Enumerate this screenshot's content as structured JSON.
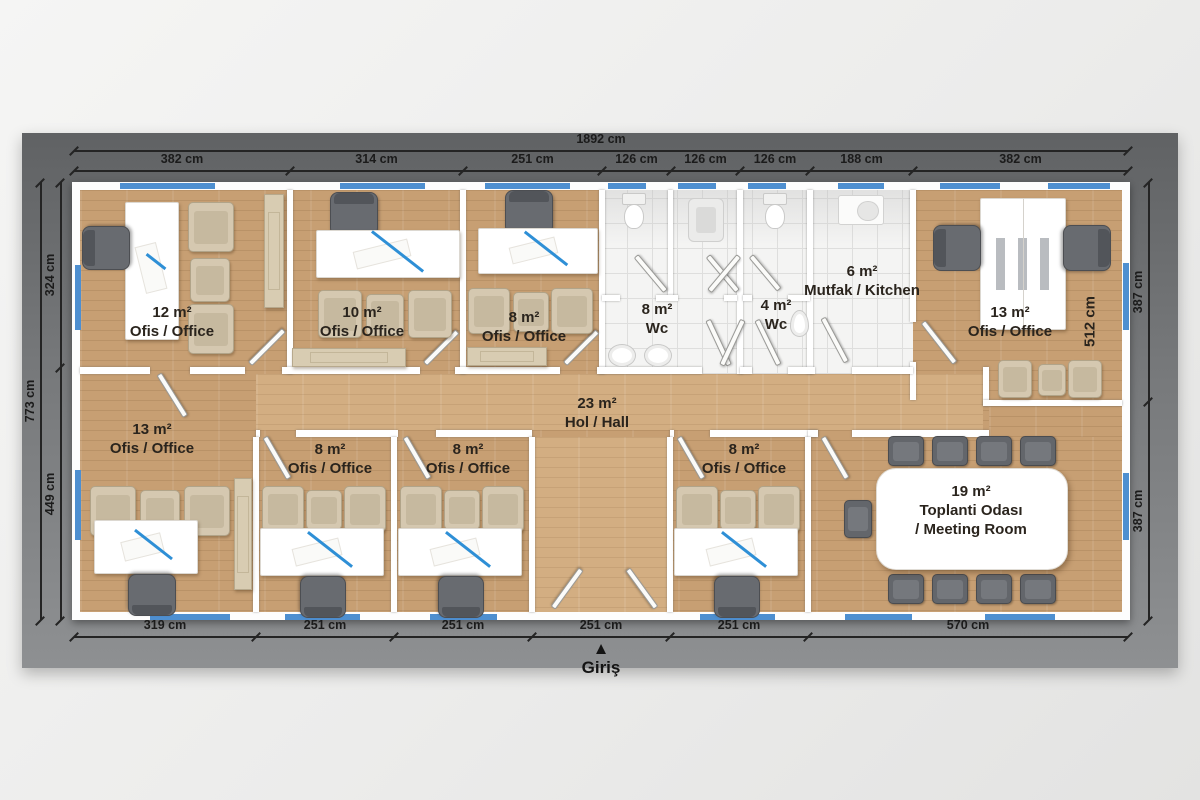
{
  "plan": {
    "entrance": {
      "arrow": "▲",
      "label": "Giriş"
    },
    "colors": {
      "mat": "#77797b",
      "wall": "#ffffff",
      "wood_floor": "#c79f73",
      "hall_floor": "#d3ae82",
      "tile_floor": "#f4f4f3",
      "window_blue": "#4e8fd0",
      "dimension_text": "#1b1b1b",
      "label_text": "#2a241d"
    },
    "labels": [
      {
        "x": 172,
        "y": 303,
        "lines": [
          "12 m²",
          "Ofis / Office"
        ]
      },
      {
        "x": 362,
        "y": 303,
        "lines": [
          "10 m²",
          "Ofis / Office"
        ]
      },
      {
        "x": 524,
        "y": 308,
        "lines": [
          "8 m²",
          "Ofis / Office"
        ]
      },
      {
        "x": 657,
        "y": 300,
        "lines": [
          "8 m²",
          "Wc"
        ]
      },
      {
        "x": 776,
        "y": 296,
        "lines": [
          "4 m²",
          "Wc"
        ]
      },
      {
        "x": 862,
        "y": 262,
        "lines": [
          "6 m²",
          "Mutfak / Kitchen"
        ]
      },
      {
        "x": 1010,
        "y": 303,
        "lines": [
          "13 m²",
          "Ofis / Office"
        ]
      },
      {
        "x": 597,
        "y": 394,
        "lines": [
          "23 m²",
          "Hol / Hall"
        ]
      },
      {
        "x": 152,
        "y": 420,
        "lines": [
          "13 m²",
          "Ofis / Office"
        ]
      },
      {
        "x": 330,
        "y": 440,
        "lines": [
          "8 m²",
          "Ofis / Office"
        ]
      },
      {
        "x": 468,
        "y": 440,
        "lines": [
          "8 m²",
          "Ofis / Office"
        ]
      },
      {
        "x": 744,
        "y": 440,
        "lines": [
          "8 m²",
          "Ofis / Office"
        ]
      },
      {
        "x": 971,
        "y": 482,
        "lines": [
          "19 m²",
          "Toplanti Odası",
          "/ Meeting Room"
        ]
      },
      {
        "x": 1090,
        "y": 312,
        "lines": [
          "512 cm"
        ],
        "vertical": true
      }
    ],
    "dims": [
      {
        "orient": "h",
        "pos": 150,
        "ticks": [
          74,
          1128
        ],
        "labels": [
          "1892 cm"
        ],
        "name": "dim-top-total"
      },
      {
        "orient": "h",
        "pos": 170,
        "ticks": [
          74,
          290,
          463,
          602,
          671,
          740,
          810,
          913,
          1128
        ],
        "labels": [
          "382 cm",
          "314 cm",
          "251 cm",
          "126 cm",
          "126 cm",
          "126 cm",
          "188 cm",
          "382 cm"
        ],
        "name": "dim-top-segments"
      },
      {
        "orient": "v",
        "pos": 40,
        "ticks": [
          182,
          620
        ],
        "labels": [
          "773 cm"
        ],
        "name": "dim-left-total"
      },
      {
        "orient": "v",
        "pos": 60,
        "ticks": [
          182,
          367,
          620
        ],
        "labels": [
          "324 cm",
          "449 cm"
        ],
        "name": "dim-left-segments"
      },
      {
        "orient": "v",
        "pos": 1148,
        "ticks": [
          182,
          401,
          620
        ],
        "labels": [
          "387 cm",
          "387 cm"
        ],
        "name": "dim-right-segments"
      },
      {
        "orient": "h",
        "pos": 636,
        "ticks": [
          74,
          256,
          394,
          532,
          670,
          808,
          1128
        ],
        "labels": [
          "319 cm",
          "251 cm",
          "251 cm",
          "251 cm",
          "251 cm",
          "570 cm"
        ],
        "name": "dim-bottom-segments"
      }
    ]
  },
  "geometry": {
    "floors": [
      {
        "x": 80,
        "y": 190,
        "w": 1042,
        "h": 422,
        "cls": "wood",
        "name": "floor-wood-base"
      },
      {
        "x": 602,
        "y": 190,
        "w": 311,
        "h": 184,
        "cls": "tile",
        "name": "floor-tiles-wet-area"
      },
      {
        "x": 256,
        "y": 374,
        "w": 727,
        "h": 56,
        "cls": "wood-light",
        "name": "floor-hall"
      },
      {
        "x": 532,
        "y": 437,
        "w": 138,
        "h": 175,
        "cls": "wood-light",
        "name": "floor-entry-corridor"
      },
      {
        "x": 989,
        "y": 406,
        "w": 133,
        "h": 31,
        "cls": "wood",
        "name": "floor-meeting-strip"
      }
    ],
    "walls": [
      {
        "x": 287,
        "y": 190,
        "w": 6,
        "h": 184
      },
      {
        "x": 460,
        "y": 190,
        "w": 6,
        "h": 184
      },
      {
        "x": 599,
        "y": 190,
        "w": 6,
        "h": 184
      },
      {
        "x": 668,
        "y": 190,
        "w": 5,
        "h": 108
      },
      {
        "x": 737,
        "y": 190,
        "w": 6,
        "h": 184
      },
      {
        "x": 807,
        "y": 190,
        "w": 6,
        "h": 184
      },
      {
        "x": 910,
        "y": 190,
        "w": 6,
        "h": 132
      },
      {
        "x": 910,
        "y": 362,
        "w": 6,
        "h": 38
      },
      {
        "x": 602,
        "y": 295,
        "w": 18,
        "h": 6
      },
      {
        "x": 656,
        "y": 295,
        "w": 22,
        "h": 6
      },
      {
        "x": 724,
        "y": 295,
        "w": 13,
        "h": 6
      },
      {
        "x": 743,
        "y": 295,
        "w": 9,
        "h": 6
      },
      {
        "x": 788,
        "y": 295,
        "w": 22,
        "h": 6
      },
      {
        "x": 80,
        "y": 367,
        "w": 70,
        "h": 7
      },
      {
        "x": 190,
        "y": 367,
        "w": 55,
        "h": 7
      },
      {
        "x": 282,
        "y": 367,
        "w": 138,
        "h": 7
      },
      {
        "x": 455,
        "y": 367,
        "w": 105,
        "h": 7
      },
      {
        "x": 597,
        "y": 367,
        "w": 105,
        "h": 7
      },
      {
        "x": 740,
        "y": 367,
        "w": 12,
        "h": 7
      },
      {
        "x": 788,
        "y": 367,
        "w": 27,
        "h": 7
      },
      {
        "x": 852,
        "y": 367,
        "w": 61,
        "h": 7
      },
      {
        "x": 256,
        "y": 430,
        "w": 4,
        "h": 7
      },
      {
        "x": 296,
        "y": 430,
        "w": 102,
        "h": 7
      },
      {
        "x": 436,
        "y": 430,
        "w": 96,
        "h": 7
      },
      {
        "x": 670,
        "y": 430,
        "w": 4,
        "h": 7
      },
      {
        "x": 710,
        "y": 430,
        "w": 108,
        "h": 7
      },
      {
        "x": 852,
        "y": 430,
        "w": 137,
        "h": 7
      },
      {
        "x": 808,
        "y": 430,
        "w": 10,
        "h": 7
      },
      {
        "x": 253,
        "y": 437,
        "w": 6,
        "h": 175
      },
      {
        "x": 391,
        "y": 437,
        "w": 6,
        "h": 175
      },
      {
        "x": 529,
        "y": 437,
        "w": 6,
        "h": 175
      },
      {
        "x": 667,
        "y": 437,
        "w": 6,
        "h": 175
      },
      {
        "x": 805,
        "y": 437,
        "w": 6,
        "h": 175
      },
      {
        "x": 983,
        "y": 367,
        "w": 6,
        "h": 39
      },
      {
        "x": 983,
        "y": 400,
        "w": 139,
        "h": 6
      }
    ],
    "windows": [
      {
        "x": 120,
        "y": 183,
        "w": 95,
        "h": 6
      },
      {
        "x": 340,
        "y": 183,
        "w": 85,
        "h": 6
      },
      {
        "x": 485,
        "y": 183,
        "w": 85,
        "h": 6
      },
      {
        "x": 608,
        "y": 183,
        "w": 38,
        "h": 6
      },
      {
        "x": 678,
        "y": 183,
        "w": 38,
        "h": 6
      },
      {
        "x": 748,
        "y": 183,
        "w": 38,
        "h": 6
      },
      {
        "x": 838,
        "y": 183,
        "w": 46,
        "h": 6
      },
      {
        "x": 940,
        "y": 183,
        "w": 60,
        "h": 6
      },
      {
        "x": 1048,
        "y": 183,
        "w": 62,
        "h": 6
      },
      {
        "x": 150,
        "y": 614,
        "w": 80,
        "h": 6
      },
      {
        "x": 285,
        "y": 614,
        "w": 75,
        "h": 6
      },
      {
        "x": 430,
        "y": 614,
        "w": 67,
        "h": 6
      },
      {
        "x": 700,
        "y": 614,
        "w": 75,
        "h": 6
      },
      {
        "x": 845,
        "y": 614,
        "w": 67,
        "h": 6
      },
      {
        "x": 985,
        "y": 614,
        "w": 70,
        "h": 6
      },
      {
        "x": 75,
        "y": 265,
        "w": 6,
        "h": 65
      },
      {
        "x": 75,
        "y": 470,
        "w": 6,
        "h": 70
      },
      {
        "x": 1123,
        "y": 263,
        "w": 6,
        "h": 67
      },
      {
        "x": 1123,
        "y": 473,
        "w": 6,
        "h": 67
      }
    ],
    "doors": [
      {
        "x": 247,
        "y": 364,
        "len": 46,
        "deg": -135,
        "name": "door-office-12"
      },
      {
        "x": 422,
        "y": 364,
        "len": 44,
        "deg": -135,
        "name": "door-office-10"
      },
      {
        "x": 562,
        "y": 364,
        "len": 44,
        "deg": -135,
        "name": "door-office-8-top"
      },
      {
        "x": 633,
        "y": 256,
        "len": 44,
        "deg": -40,
        "name": "door-wc-stall-1"
      },
      {
        "x": 705,
        "y": 256,
        "len": 44,
        "deg": -40,
        "name": "door-wc-stall-2a"
      },
      {
        "x": 736,
        "y": 256,
        "len": 44,
        "deg": 40,
        "name": "door-wc-stall-2b"
      },
      {
        "x": 748,
        "y": 256,
        "len": 42,
        "deg": -40,
        "name": "door-wc-stall-3"
      },
      {
        "x": 705,
        "y": 320,
        "len": 48,
        "deg": -25,
        "name": "door-wc-8-entry-a"
      },
      {
        "x": 740,
        "y": 320,
        "len": 48,
        "deg": 25,
        "name": "door-wc-8-entry-b"
      },
      {
        "x": 754,
        "y": 320,
        "len": 48,
        "deg": -26,
        "name": "door-wc-4-entry"
      },
      {
        "x": 820,
        "y": 318,
        "len": 48,
        "deg": -28,
        "name": "door-kitchen"
      },
      {
        "x": 920,
        "y": 322,
        "len": 50,
        "deg": -38,
        "name": "door-office-13-top"
      },
      {
        "x": 820,
        "y": 437,
        "len": 46,
        "deg": -30,
        "name": "door-meeting-room"
      },
      {
        "x": 156,
        "y": 374,
        "len": 48,
        "deg": -32,
        "name": "door-office-13-bottom"
      },
      {
        "x": 262,
        "y": 437,
        "len": 46,
        "deg": -30,
        "name": "door-office-8-b1"
      },
      {
        "x": 402,
        "y": 437,
        "len": 46,
        "deg": -30,
        "name": "door-office-8-b2"
      },
      {
        "x": 676,
        "y": 437,
        "len": 46,
        "deg": -30,
        "name": "door-office-8-b3"
      },
      {
        "x": 550,
        "y": 608,
        "len": 46,
        "deg": -144,
        "name": "door-entrance-left"
      },
      {
        "x": 653,
        "y": 608,
        "len": 46,
        "deg": 144,
        "name": "door-entrance-right"
      }
    ],
    "furniture": [
      {
        "type": "cabinet",
        "x": 264,
        "y": 194,
        "w": 18,
        "h": 112
      },
      {
        "type": "desk",
        "x": 125,
        "y": 202,
        "w": 52,
        "h": 136
      },
      {
        "type": "ochair",
        "x": 84,
        "y": 224,
        "w": 42,
        "h": 46,
        "deg": -90
      },
      {
        "type": "gchair",
        "x": 188,
        "y": 202,
        "w": 44,
        "h": 48
      },
      {
        "type": "gchair",
        "x": 190,
        "y": 258,
        "w": 38,
        "h": 42
      },
      {
        "type": "gchair",
        "x": 188,
        "y": 304,
        "w": 44,
        "h": 48
      },
      {
        "type": "ochair",
        "x": 330,
        "y": 192,
        "w": 46,
        "h": 42
      },
      {
        "type": "desk",
        "x": 316,
        "y": 230,
        "w": 142,
        "h": 46
      },
      {
        "type": "gchair",
        "x": 318,
        "y": 290,
        "w": 42,
        "h": 46
      },
      {
        "type": "gchair",
        "x": 366,
        "y": 294,
        "w": 36,
        "h": 40
      },
      {
        "type": "gchair",
        "x": 408,
        "y": 290,
        "w": 42,
        "h": 46
      },
      {
        "type": "credenza",
        "x": 292,
        "y": 348,
        "w": 112,
        "h": 17
      },
      {
        "type": "ochair",
        "x": 505,
        "y": 190,
        "w": 46,
        "h": 42
      },
      {
        "type": "desk",
        "x": 478,
        "y": 228,
        "w": 118,
        "h": 44
      },
      {
        "type": "gchair",
        "x": 468,
        "y": 288,
        "w": 40,
        "h": 44
      },
      {
        "type": "gchair",
        "x": 513,
        "y": 292,
        "w": 34,
        "h": 38
      },
      {
        "type": "gchair",
        "x": 551,
        "y": 288,
        "w": 40,
        "h": 44
      },
      {
        "type": "credenza",
        "x": 467,
        "y": 347,
        "w": 78,
        "h": 17
      },
      {
        "type": "toilet",
        "x": 622,
        "y": 193,
        "w": 24,
        "h": 36
      },
      {
        "type": "squat",
        "x": 688,
        "y": 198,
        "w": 34,
        "h": 42
      },
      {
        "type": "sink-round",
        "x": 608,
        "y": 344,
        "w": 26,
        "h": 21
      },
      {
        "type": "sink-round",
        "x": 644,
        "y": 344,
        "w": 26,
        "h": 21
      },
      {
        "type": "toilet",
        "x": 763,
        "y": 193,
        "w": 24,
        "h": 36
      },
      {
        "type": "sink-wall",
        "x": 790,
        "y": 310,
        "w": 17,
        "h": 25
      },
      {
        "type": "sink-kitchen",
        "x": 838,
        "y": 195,
        "w": 44,
        "h": 28
      },
      {
        "type": "desk-double",
        "x": 980,
        "y": 198,
        "w": 84,
        "h": 130
      },
      {
        "type": "ochair",
        "x": 934,
        "y": 224,
        "w": 44,
        "h": 46,
        "deg": -90
      },
      {
        "type": "ochair",
        "x": 1064,
        "y": 224,
        "w": 44,
        "h": 46,
        "deg": 90
      },
      {
        "type": "gchair",
        "x": 998,
        "y": 360,
        "w": 32,
        "h": 36
      },
      {
        "type": "gchair",
        "x": 1038,
        "y": 364,
        "w": 26,
        "h": 30
      },
      {
        "type": "gchair",
        "x": 1068,
        "y": 360,
        "w": 32,
        "h": 36
      },
      {
        "type": "gchair",
        "x": 90,
        "y": 486,
        "w": 44,
        "h": 48
      },
      {
        "type": "gchair",
        "x": 140,
        "y": 490,
        "w": 38,
        "h": 42
      },
      {
        "type": "gchair",
        "x": 184,
        "y": 486,
        "w": 44,
        "h": 48
      },
      {
        "type": "desk",
        "x": 94,
        "y": 520,
        "w": 102,
        "h": 52
      },
      {
        "type": "ochair",
        "x": 128,
        "y": 574,
        "w": 46,
        "h": 40,
        "deg": 180
      },
      {
        "type": "cabinet",
        "x": 234,
        "y": 478,
        "w": 16,
        "h": 110
      },
      {
        "type": "gchair",
        "x": 262,
        "y": 486,
        "w": 40,
        "h": 44
      },
      {
        "type": "gchair",
        "x": 306,
        "y": 490,
        "w": 34,
        "h": 38
      },
      {
        "type": "gchair",
        "x": 344,
        "y": 486,
        "w": 40,
        "h": 44
      },
      {
        "type": "desk",
        "x": 260,
        "y": 528,
        "w": 122,
        "h": 46
      },
      {
        "type": "ochair",
        "x": 300,
        "y": 576,
        "w": 44,
        "h": 40,
        "deg": 180
      },
      {
        "type": "gchair",
        "x": 400,
        "y": 486,
        "w": 40,
        "h": 44
      },
      {
        "type": "gchair",
        "x": 444,
        "y": 490,
        "w": 34,
        "h": 38
      },
      {
        "type": "gchair",
        "x": 482,
        "y": 486,
        "w": 40,
        "h": 44
      },
      {
        "type": "desk",
        "x": 398,
        "y": 528,
        "w": 122,
        "h": 46
      },
      {
        "type": "ochair",
        "x": 438,
        "y": 576,
        "w": 44,
        "h": 40,
        "deg": 180
      },
      {
        "type": "gchair",
        "x": 676,
        "y": 486,
        "w": 40,
        "h": 44
      },
      {
        "type": "gchair",
        "x": 720,
        "y": 490,
        "w": 34,
        "h": 38
      },
      {
        "type": "gchair",
        "x": 758,
        "y": 486,
        "w": 40,
        "h": 44
      },
      {
        "type": "desk",
        "x": 674,
        "y": 528,
        "w": 122,
        "h": 46
      },
      {
        "type": "ochair",
        "x": 714,
        "y": 576,
        "w": 44,
        "h": 40,
        "deg": 180
      },
      {
        "type": "mchair",
        "x": 888,
        "y": 436,
        "w": 34,
        "h": 28
      },
      {
        "type": "mchair",
        "x": 932,
        "y": 436,
        "w": 34,
        "h": 28
      },
      {
        "type": "mchair",
        "x": 976,
        "y": 436,
        "w": 34,
        "h": 28
      },
      {
        "type": "mchair",
        "x": 1020,
        "y": 436,
        "w": 34,
        "h": 28
      },
      {
        "type": "mchair",
        "x": 888,
        "y": 574,
        "w": 34,
        "h": 28
      },
      {
        "type": "mchair",
        "x": 932,
        "y": 574,
        "w": 34,
        "h": 28
      },
      {
        "type": "mchair",
        "x": 976,
        "y": 574,
        "w": 34,
        "h": 28
      },
      {
        "type": "mchair",
        "x": 1020,
        "y": 574,
        "w": 34,
        "h": 28
      },
      {
        "type": "mchair",
        "x": 844,
        "y": 500,
        "w": 26,
        "h": 36
      },
      {
        "type": "table-meeting",
        "x": 876,
        "y": 468,
        "w": 190,
        "h": 100
      }
    ]
  }
}
